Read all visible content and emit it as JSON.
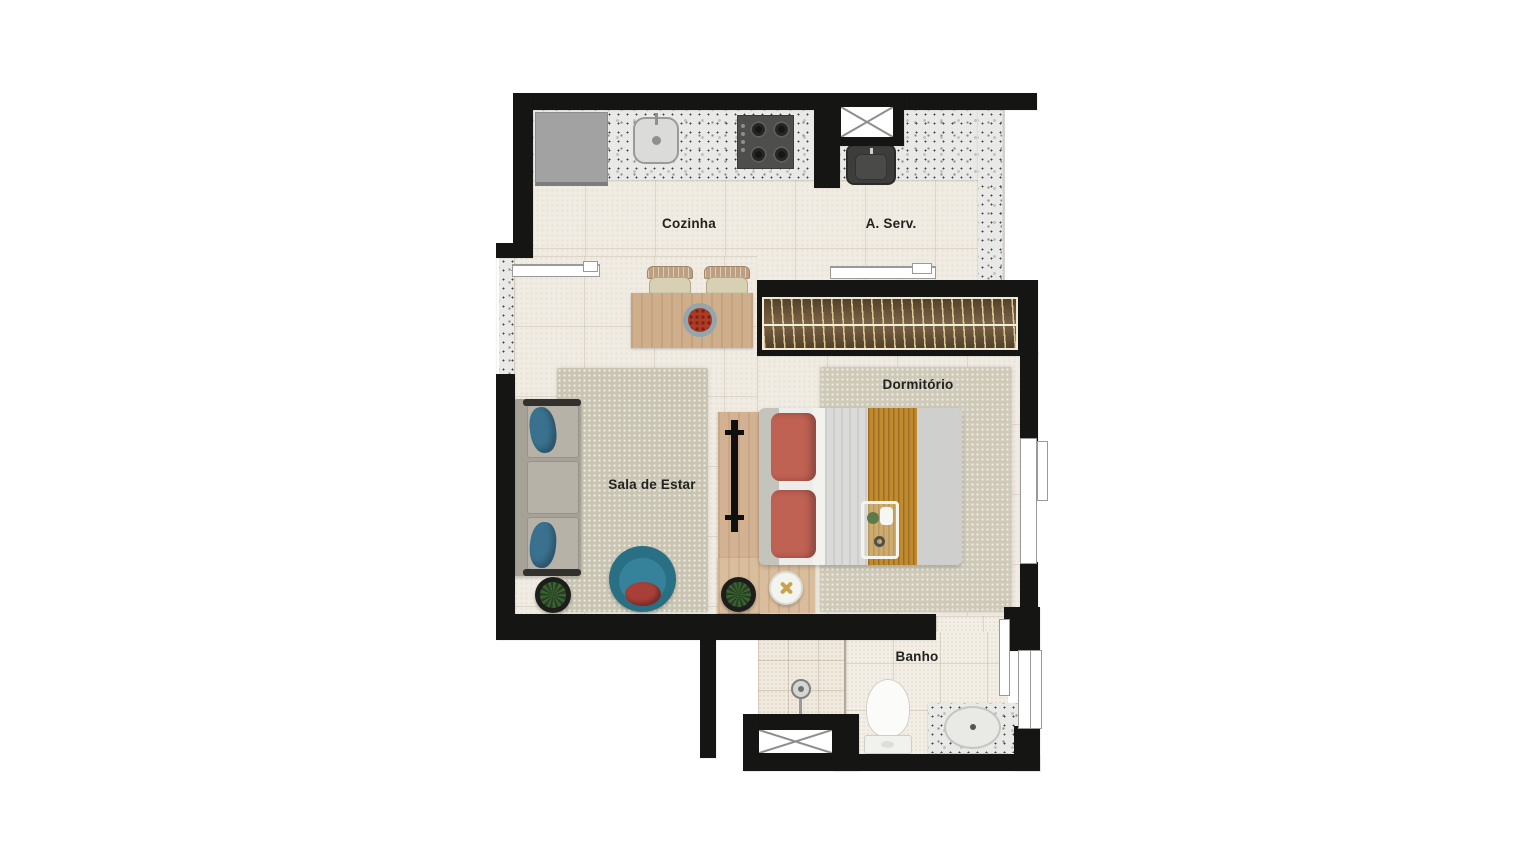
{
  "plan_title": "Planta de apartamento (studio)",
  "rooms": {
    "cozinha": {
      "label": "Cozinha"
    },
    "aserv": {
      "label": "A. Serv."
    },
    "sala": {
      "label": "Sala de Estar"
    },
    "dormitorio": {
      "label": "Dormitório"
    },
    "banho": {
      "label": "Banho"
    }
  },
  "palette": {
    "wall": "#151514",
    "floor_tile": "#f1ece3",
    "bath_tile": "#f4efe6",
    "granite_counter": "#e9e9e7",
    "rug": "#cac5b3",
    "wood": "#cfae8c",
    "wardrobe_wood": "#6e5637",
    "sofa_gray": "#b6b2a8",
    "accent_teal": "#2a7084",
    "accent_blue_pillow": "#39718f",
    "accent_coral": "#bf6153",
    "accent_red_cushion": "#a83f38",
    "accent_mustard": "#c08a2e",
    "appliance_dark": "#4e4e4c",
    "fixture_white": "#fbfbf9",
    "label_text": "#222220"
  },
  "symbols": [
    "shaft-x-icon",
    "window-symbol",
    "sliding-door-symbol"
  ]
}
